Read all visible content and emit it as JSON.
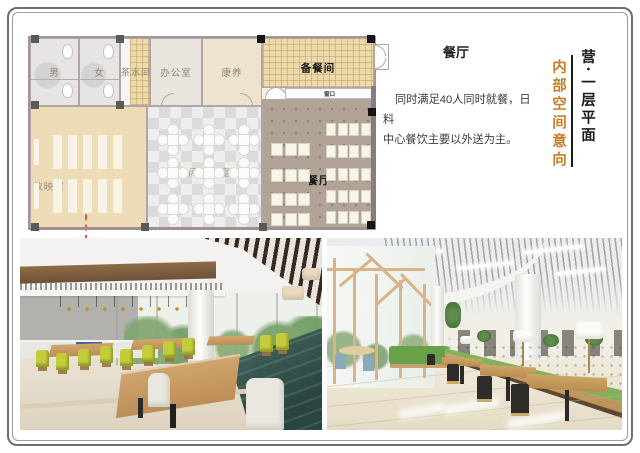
{
  "slide": {
    "background": "#ffffff",
    "border_color": "#6e6e6e"
  },
  "floor_plan": {
    "rooms": [
      {
        "name": "mens-restroom",
        "label": "男"
      },
      {
        "name": "womens-restroom",
        "label": "女"
      },
      {
        "name": "tea-room",
        "label": "茶水间"
      },
      {
        "name": "office",
        "label": "办公室"
      },
      {
        "name": "wellness-room",
        "label": "康养"
      },
      {
        "name": "prep-room",
        "label": "备餐间"
      },
      {
        "name": "serving-window",
        "label": "窗口"
      },
      {
        "name": "projection-room",
        "label": "放映室"
      },
      {
        "name": "chat-lounge",
        "label": "休闲聊天室"
      },
      {
        "name": "dining-hall",
        "label": "餐厅"
      }
    ]
  },
  "text_panel": {
    "title": "餐厅",
    "body_line1": "同时满足40人同时就餐，日料",
    "body_line2": "中心餐饮主要以外送为主。"
  },
  "side_captions": {
    "orange_vertical": "内部空间意向",
    "black_vertical": "营·一层平面"
  },
  "colors": {
    "accent_orange": "#c87d2a",
    "plan_wall": "#a4959a",
    "plan_wall_dark": "#8d7a80",
    "banquette_teal": "#35534e",
    "banquette_green": "#6aa047",
    "chair_chartreuse": "#c3cd3c",
    "section_line_red": "#e2574a"
  }
}
